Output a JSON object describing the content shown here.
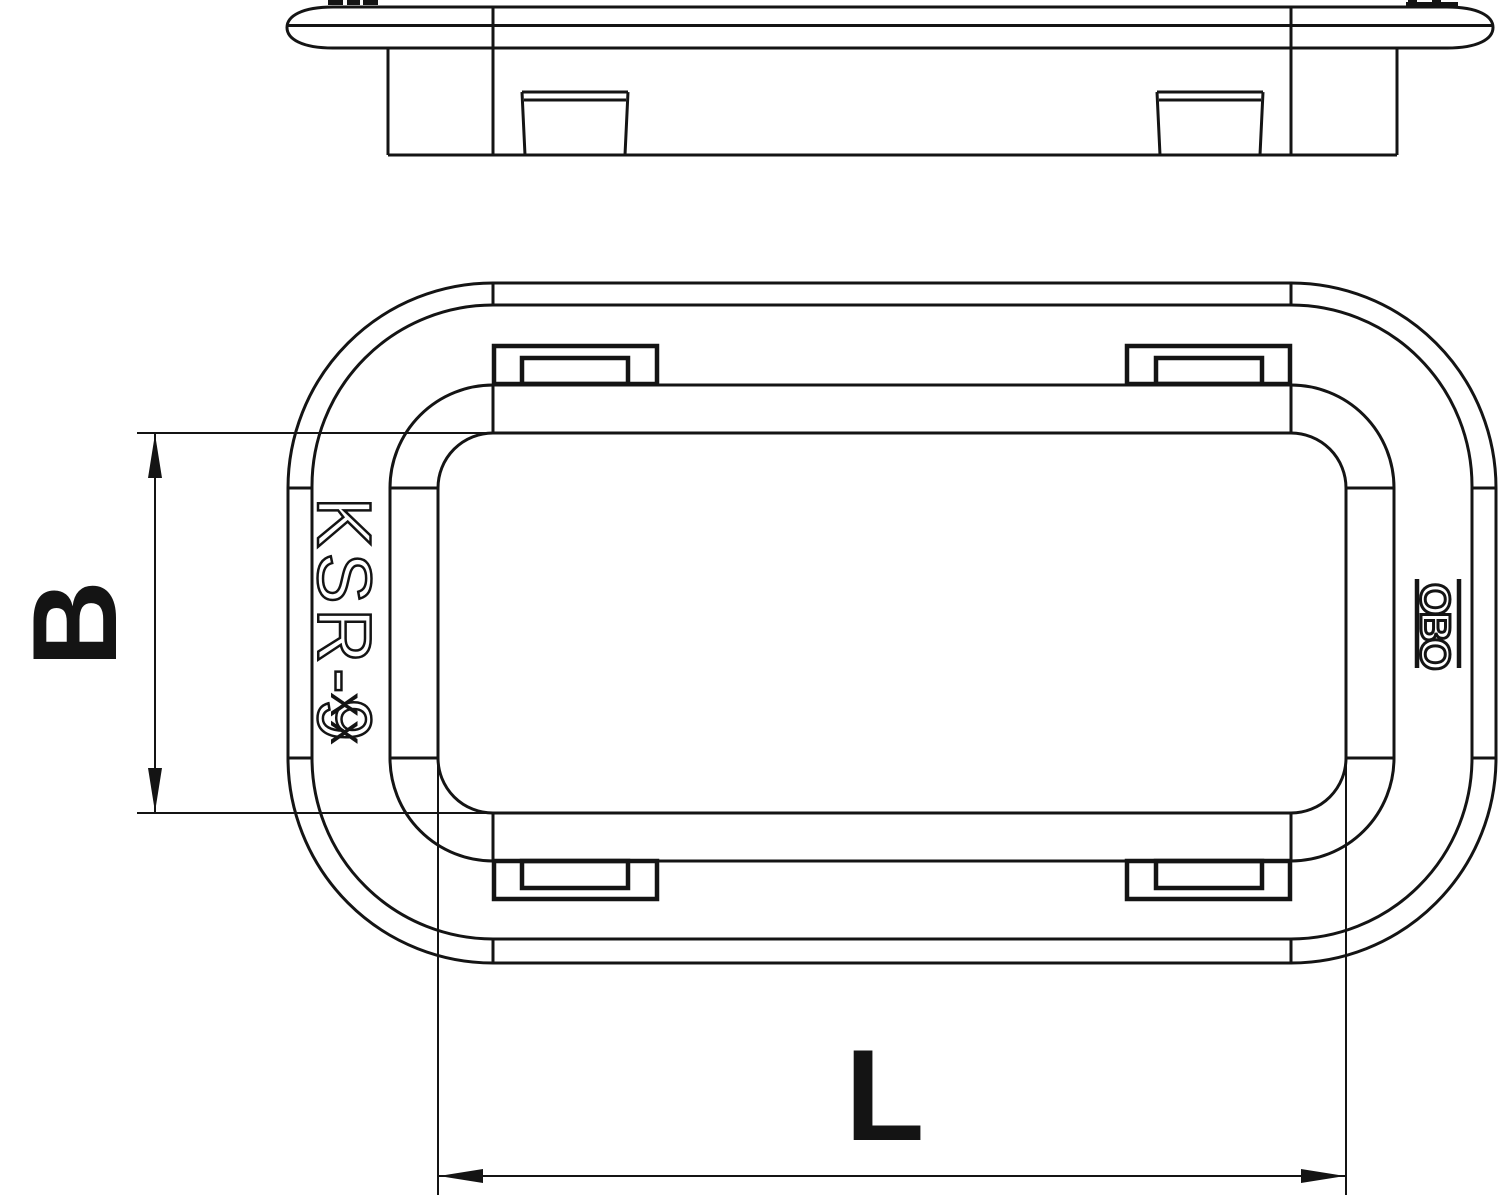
{
  "drawing": {
    "type": "technical-drawing",
    "views": {
      "side_view": "profile of grommet frame with flange, body and two latch tabs",
      "top_view": "plan view of rounded rectangular grommet frame with four latch tabs"
    },
    "part_marking": {
      "model": "KSR-9",
      "size_suffix": "xx",
      "brand": "OBO"
    },
    "dimension_labels": {
      "width": "B",
      "length": "L"
    },
    "colors": {
      "line": "#141414",
      "background": "#ffffff"
    }
  }
}
